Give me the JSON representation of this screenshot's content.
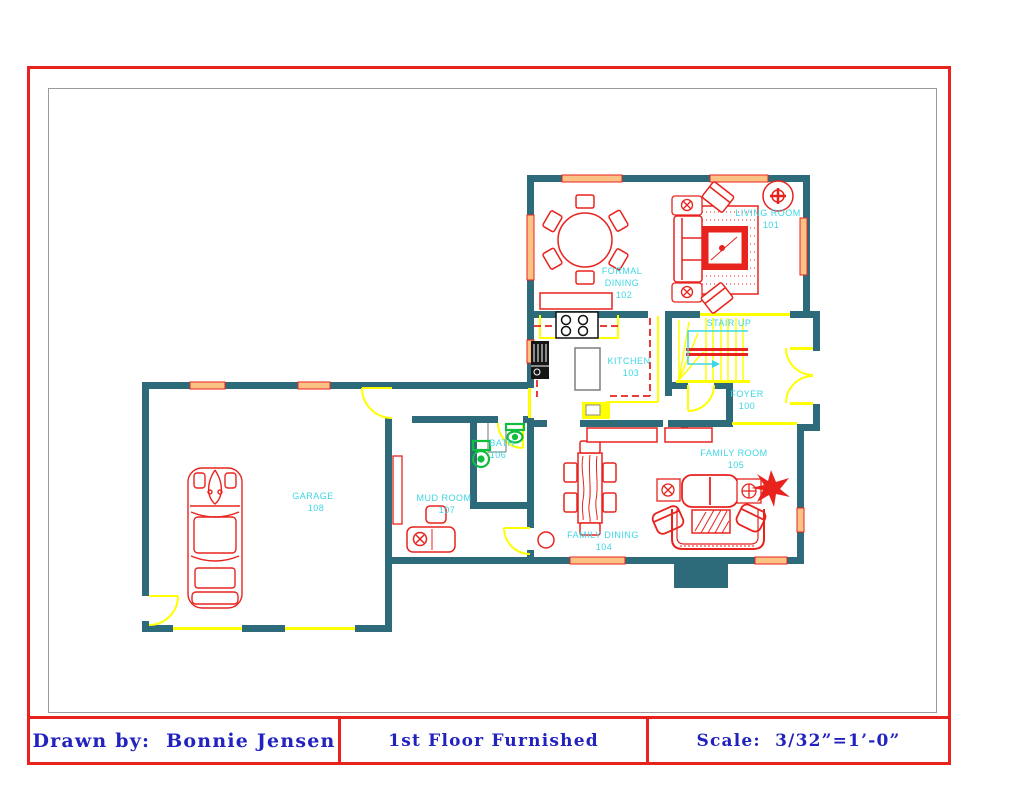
{
  "title_block": {
    "drawn_by_label": "Drawn by:",
    "drawn_by_name": "Bonnie Jensen",
    "sheet_title": "1st Floor Furnished",
    "scale_text": "Scale:  3/32”=1’-0”"
  },
  "rooms": {
    "living": {
      "name": "LIVING ROOM",
      "number": "101"
    },
    "formal_dining": {
      "line1": "FORMAL",
      "line2": "DINING",
      "number": "102"
    },
    "kitchen": {
      "name": "KITCHEN",
      "number": "103"
    },
    "family_dining": {
      "name": "FAMILY DINING",
      "number": "104"
    },
    "family_room": {
      "name": "FAMILY ROOM",
      "number": "105"
    },
    "bath": {
      "name": "BATH",
      "number": "106"
    },
    "mud_room": {
      "name": "MUD ROOM",
      "number": "107"
    },
    "garage": {
      "name": "GARAGE",
      "number": "108"
    },
    "foyer": {
      "name": "FOYER",
      "number": "100"
    }
  },
  "annotations": {
    "stair_up": "STAIR UP"
  },
  "colors": {
    "wall": "#2e6b7a",
    "furniture_red": "#e8231e",
    "door_yellow": "#ffff00",
    "label_cyan": "#3cd7e6",
    "window_peach": "#fbc285",
    "fixture_green": "#0fbe3c",
    "title_blue": "#2222bf",
    "frame_red": "#e8231e"
  }
}
